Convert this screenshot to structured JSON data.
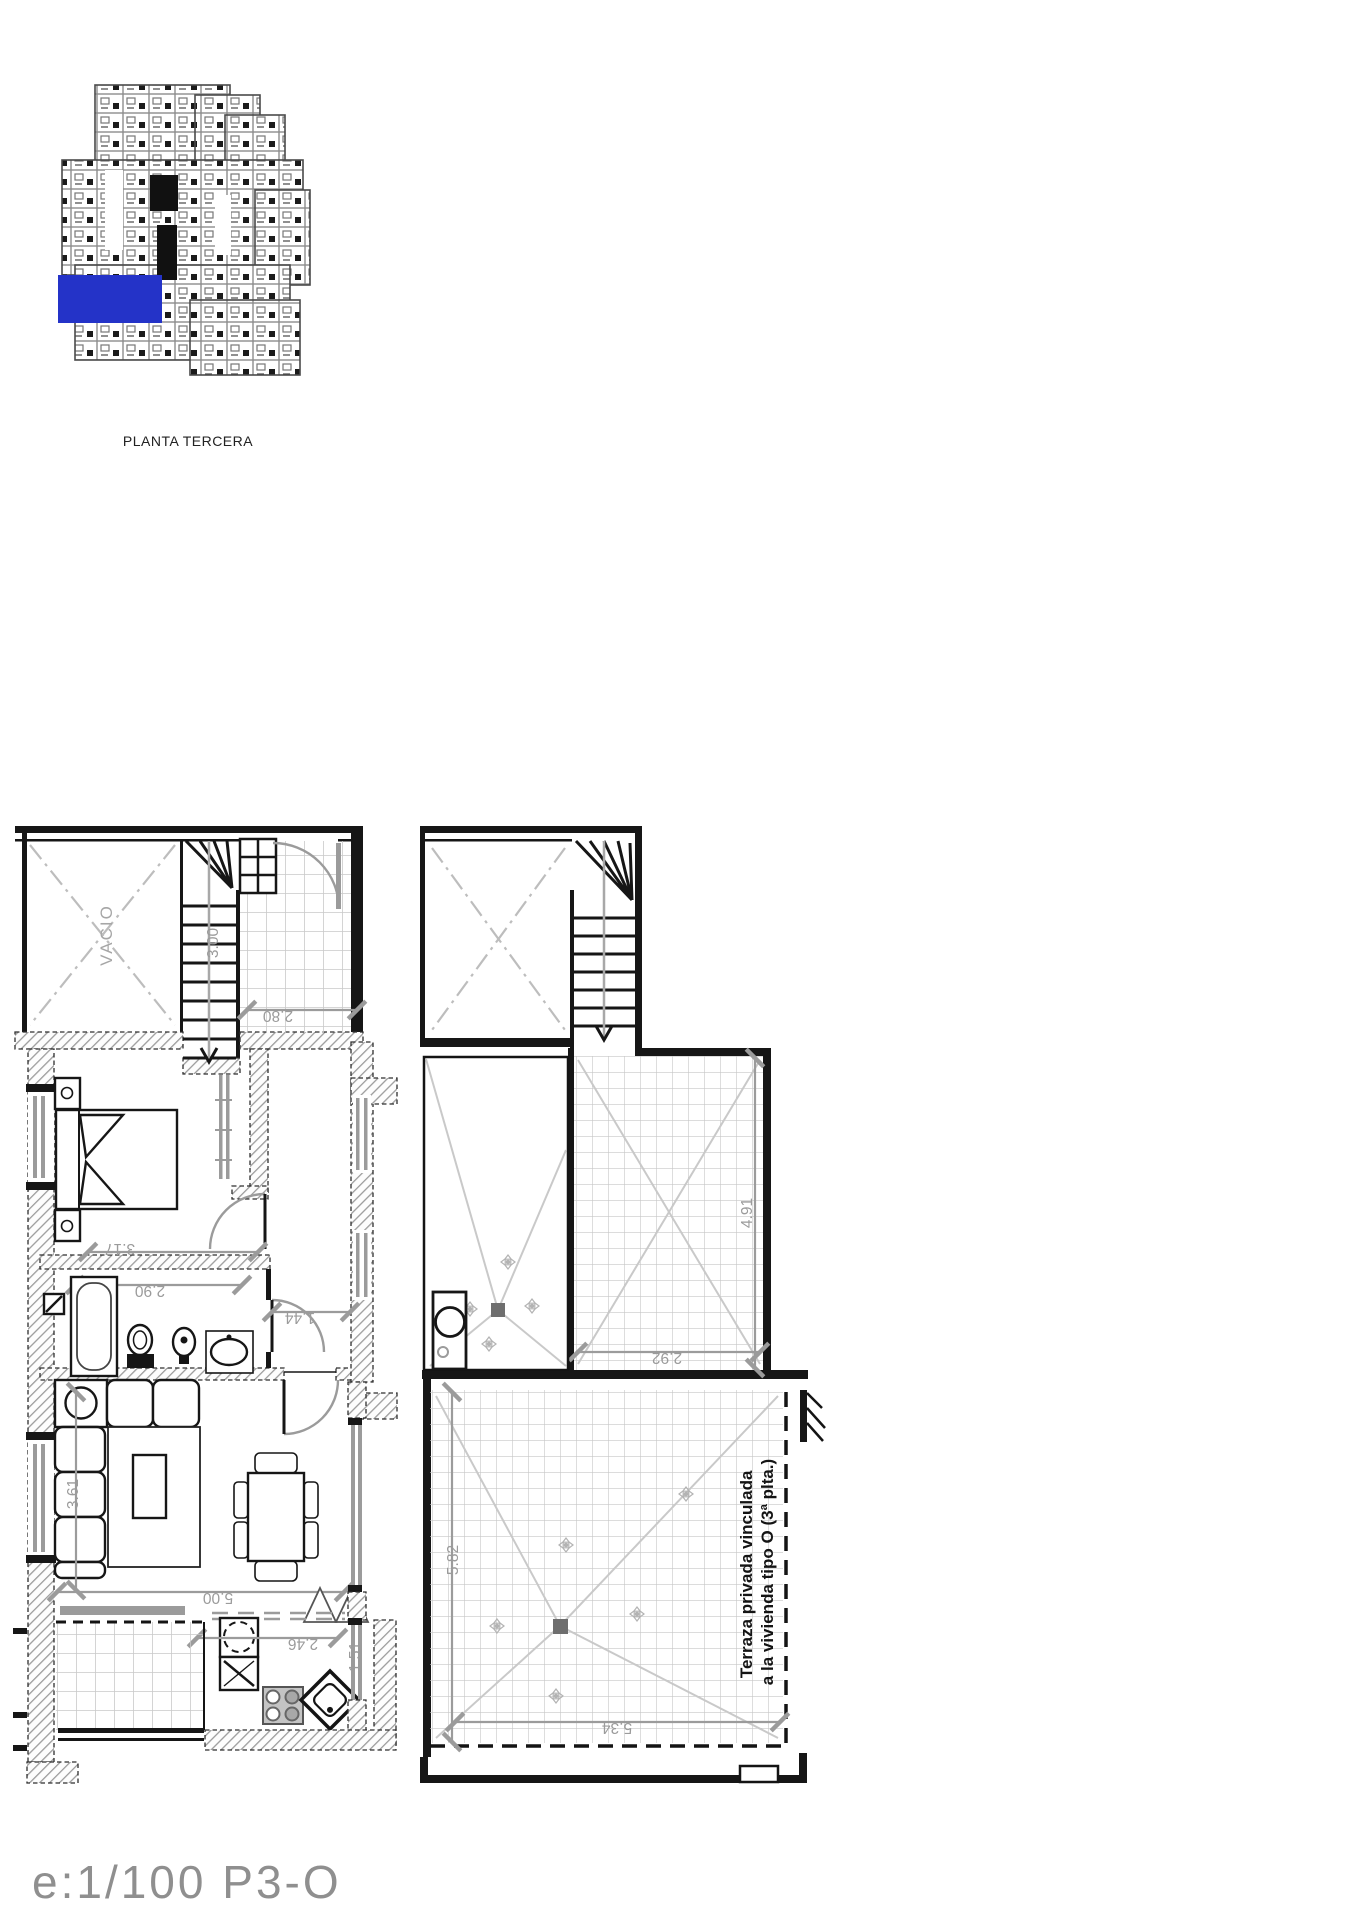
{
  "key_plan": {
    "label": "PLANTA TERCERA",
    "highlight_color": "#2433c8"
  },
  "plan": {
    "room_labels": {
      "void": "VACIO"
    },
    "terrace_note": {
      "line1": "Terraza privada vinculada",
      "line2": "a la vivienda tipo O (3ª plta.)"
    },
    "dimensions": {
      "stair_run": "3.00",
      "entry_hall_width": "2.80",
      "bedroom_width": "3.17",
      "bathroom_width": "2.90",
      "corridor_width": "1.44",
      "living_width": "5.00",
      "living_depth": "3.61",
      "kitchen_width": "2.46",
      "kitchen_window": "1.51",
      "upper_terrace_depth": "4.91",
      "upper_terrace_width": "2.92",
      "lower_terrace_depth": "5.82",
      "lower_terrace_width": "5.34"
    }
  },
  "footer": {
    "scale_label": "e:1/100  P3-O"
  }
}
